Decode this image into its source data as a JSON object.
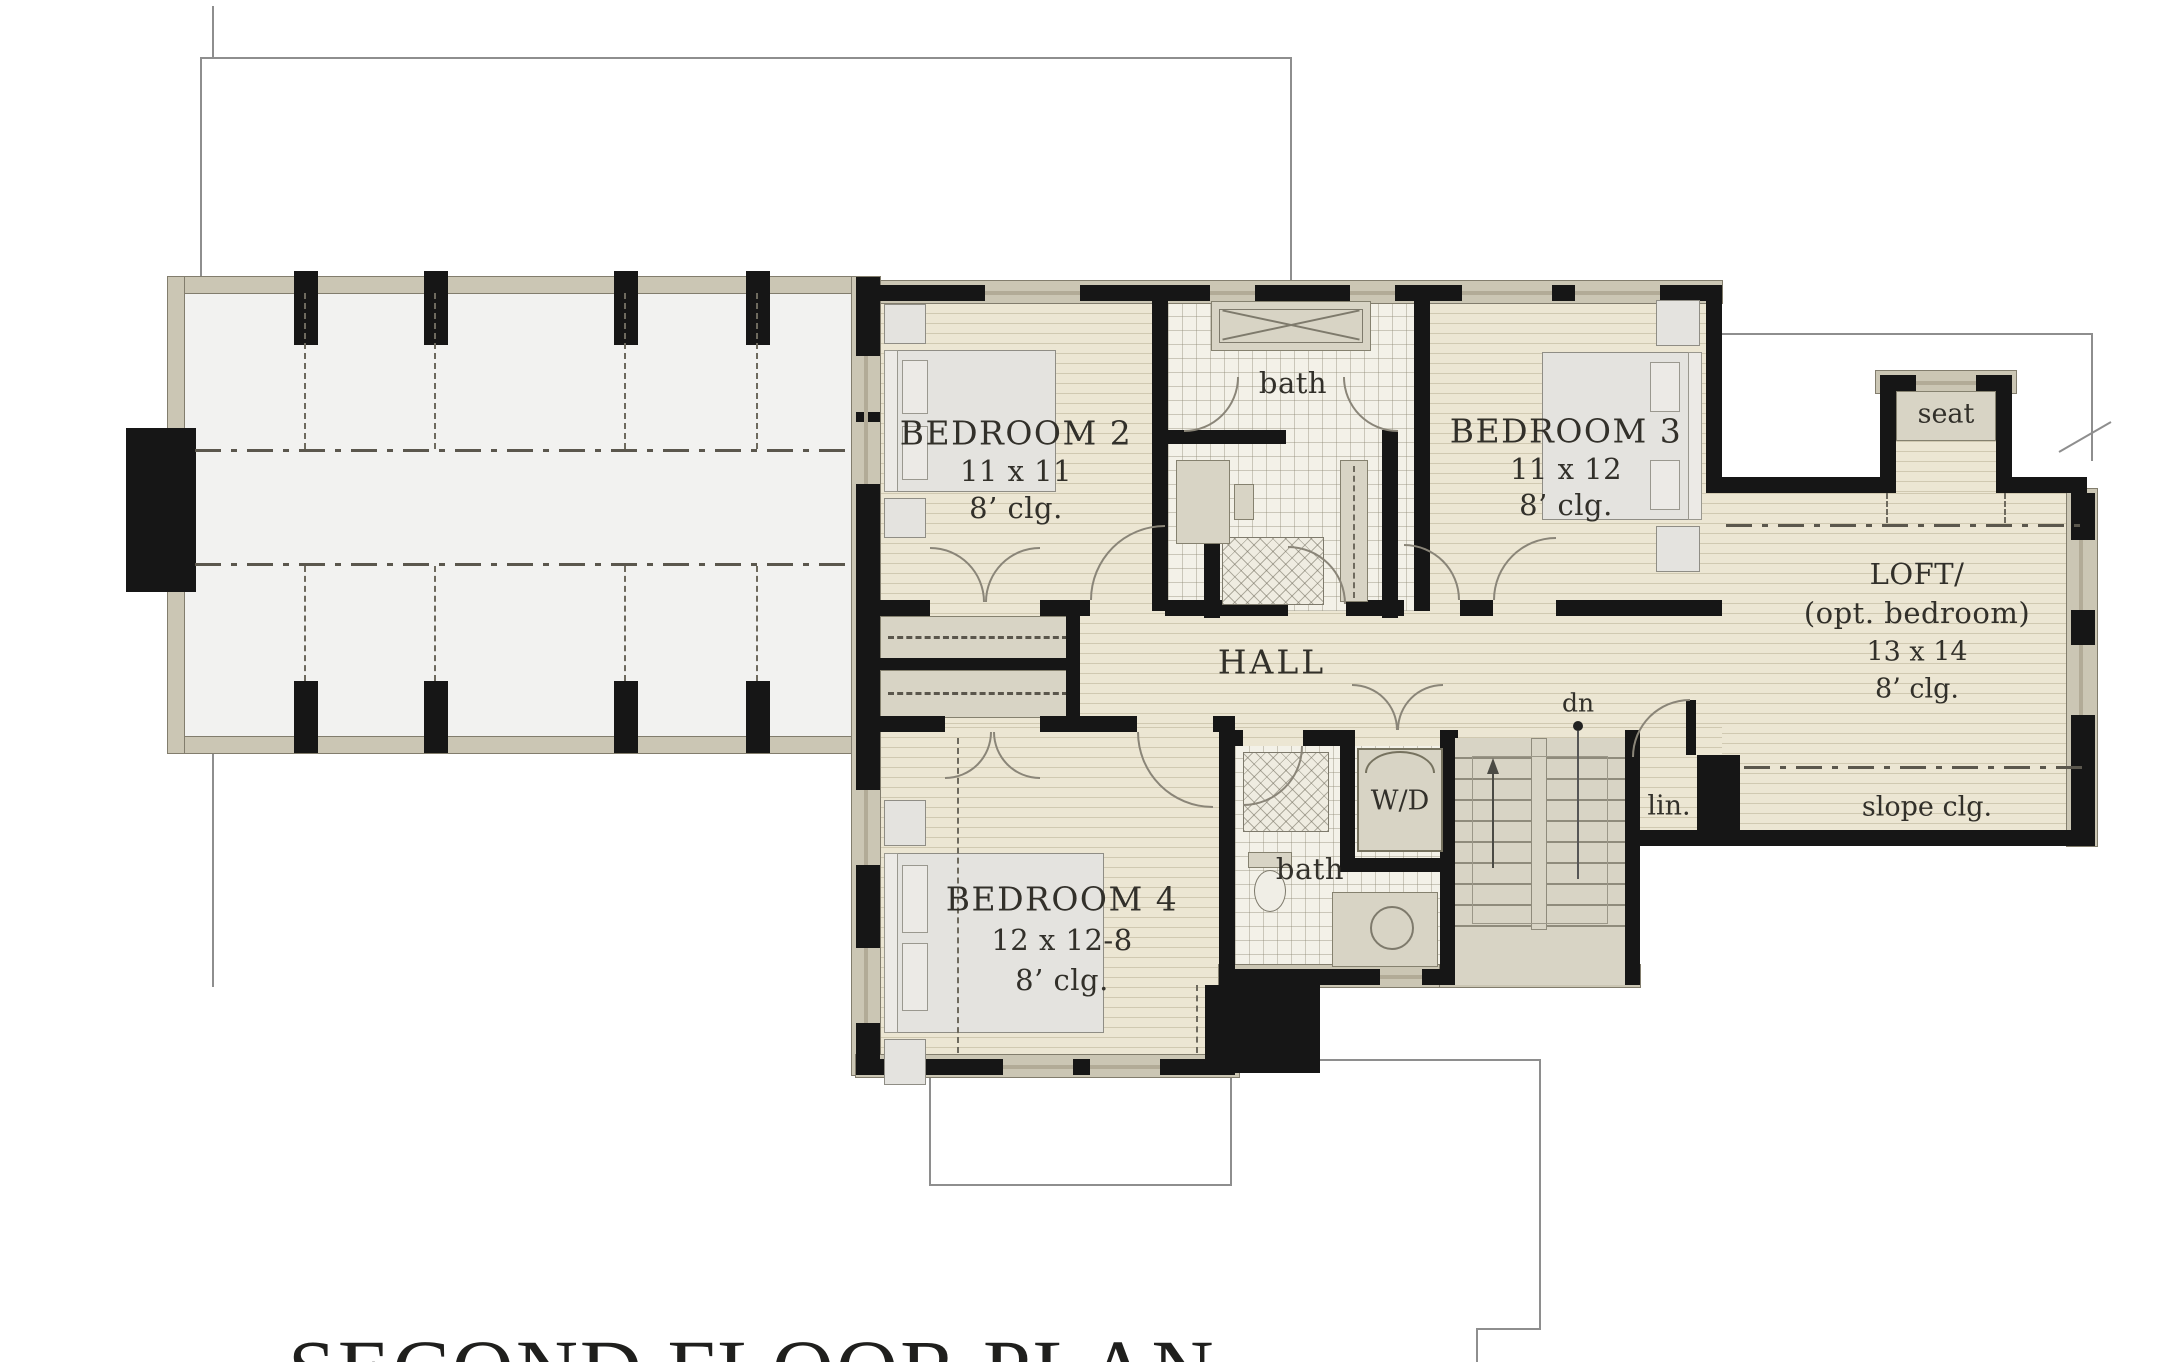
{
  "title": "SECOND FLOOR PLAN",
  "rooms": {
    "bedroom2": {
      "name": "BEDROOM 2",
      "dims": "11 x 11",
      "ceiling": "8’ clg."
    },
    "bedroom3": {
      "name": "BEDROOM 3",
      "dims": "11 x 12",
      "ceiling": "8’ clg."
    },
    "bedroom4": {
      "name": "BEDROOM 4",
      "dims": "12 x 12-8",
      "ceiling": "8’ clg."
    },
    "loft": {
      "name": "LOFT/",
      "alt": "(opt. bedroom)",
      "dims": "13 x 14",
      "ceiling": "8’ clg."
    },
    "hall": {
      "name": "HALL"
    },
    "bath_upper": {
      "name": "bath"
    },
    "bath_lower": {
      "name": "bath"
    }
  },
  "labels": {
    "seat": "seat",
    "washer_dryer": "W/D",
    "linen": "lin.",
    "slope_ceiling": "slope clg.",
    "stairs_down": "dn"
  },
  "colors": {
    "wall": "#161616",
    "floor_wood": "#ece6d3",
    "floor_tile": "#f3f1e8",
    "fill_tan": "#d8d4c5",
    "outline_thin": "#8e8e8e"
  }
}
